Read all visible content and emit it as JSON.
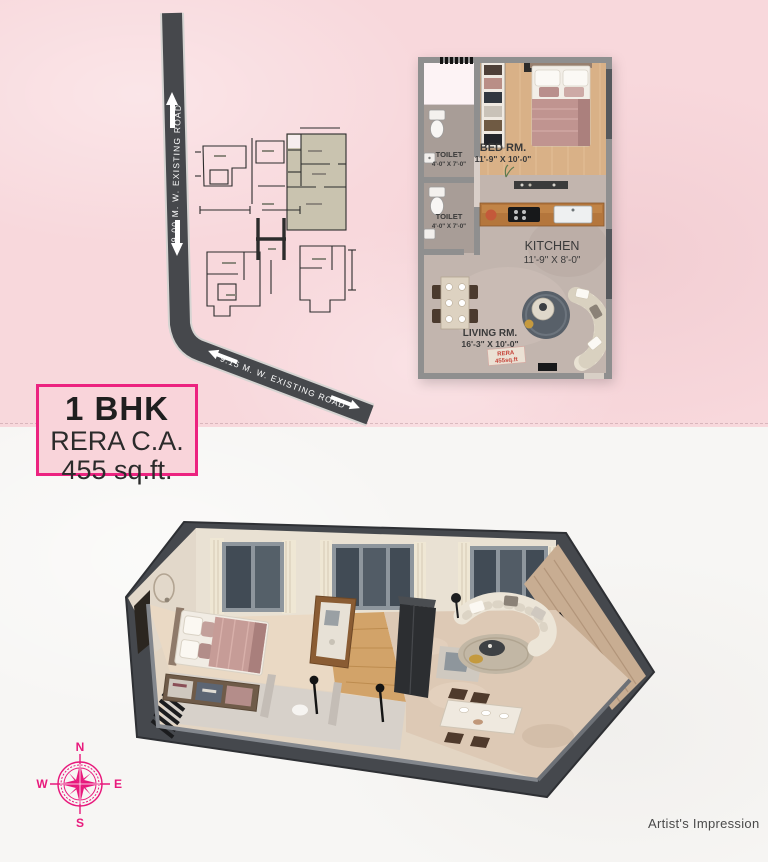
{
  "colors": {
    "background_top": "#f8d8dc",
    "background_bottom": "#f7f6f4",
    "accent_magenta": "#ec2380",
    "compass_pink": "#e8197c",
    "road_gray": "#46484c",
    "stamp_red": "#c6443a",
    "plan_wall_gray": "#8f8f8f"
  },
  "site_plan": {
    "vertical_road_label": "9.00 M. W.  EXISTING ROAD",
    "diagonal_road_label": "9.15 M. W.  EXISTING ROAD"
  },
  "unit_label": {
    "title": "1 BHK",
    "subtitle": "RERA C.A.",
    "area": "455 sq.ft."
  },
  "floor_plan_2d": {
    "bedroom": {
      "name": "BED RM.",
      "dims": "11'-9\" X 10'-0\""
    },
    "toilet_top": {
      "name": "TOILET",
      "dims": "4'-0\" X 7'-0\""
    },
    "toilet_bottom": {
      "name": "TOILET",
      "dims": "4'-0\" X 7'-0\""
    },
    "kitchen": {
      "name": "KITCHEN",
      "dims": "11'-9\" X 8'-0\""
    },
    "living": {
      "name": "LIVING RM.",
      "dims": "16'-3\" X 10'-0\""
    },
    "stamp": {
      "line1": "RERA",
      "line2": "455sq.ft"
    }
  },
  "compass": {
    "north": "N",
    "east": "E",
    "south": "S",
    "west": "W"
  },
  "footer": {
    "credit": "Artist's Impression"
  }
}
